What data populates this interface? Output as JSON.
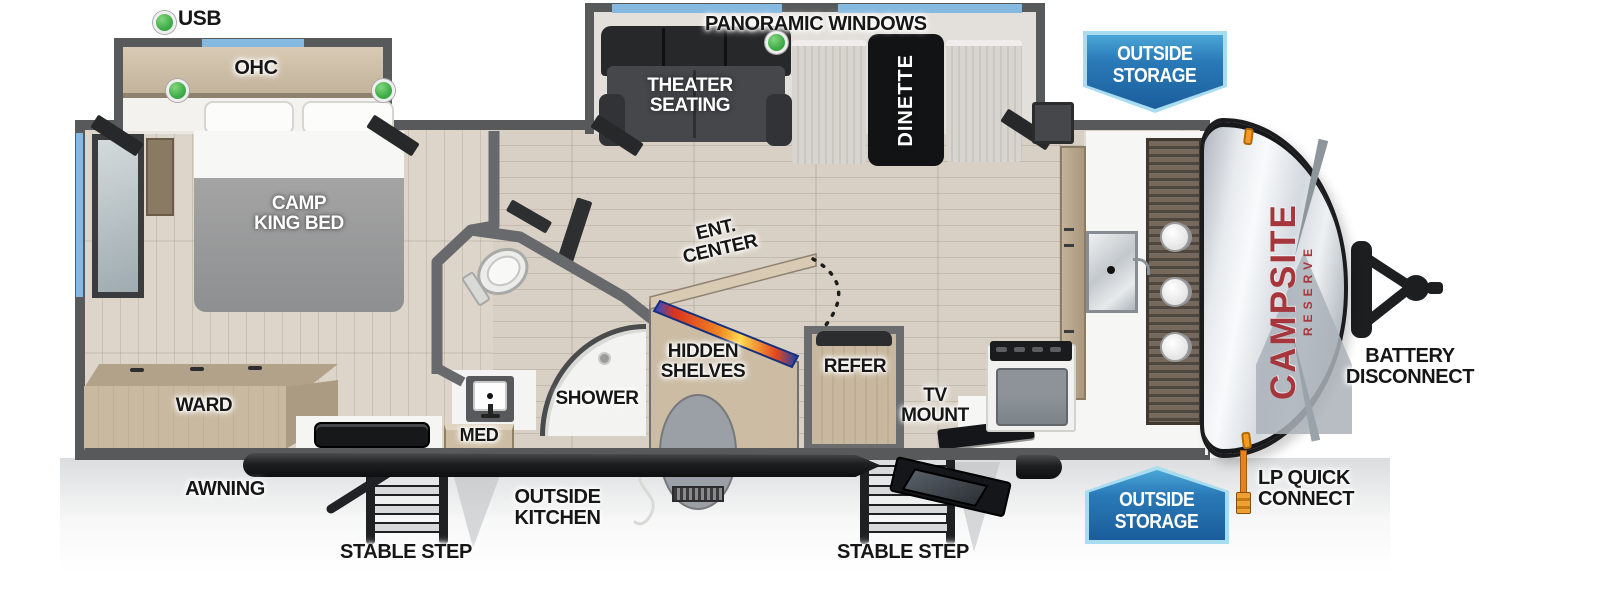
{
  "palette": {
    "wall": "#58595b",
    "window_blue": "#85b9e0",
    "badge_blue": "#1b5d9b",
    "usb_green": "#3fae49",
    "brand_red": "#a6353c",
    "wood": "#c9b9a1",
    "floor": "#d8d0c4"
  },
  "legend": {
    "usb": "USB",
    "panoramic_windows": "PANORAMIC WINDOWS"
  },
  "badges": {
    "outside_storage_top": {
      "line1": "OUTSIDE",
      "line2": "STORAGE"
    },
    "outside_storage_bottom": {
      "line1": "OUTSIDE",
      "line2": "STORAGE"
    }
  },
  "exterior": {
    "awning": "AWNING",
    "stable_step_left": "STABLE STEP",
    "stable_step_right": "STABLE STEP",
    "outside_kitchen": {
      "line1": "OUTSIDE",
      "line2": "KITCHEN"
    },
    "lp_quick_connect": {
      "line1": "LP QUICK",
      "line2": "CONNECT"
    },
    "battery_disconnect": {
      "line1": "BATTERY",
      "line2": "DISCONNECT"
    }
  },
  "brand": {
    "name": "CAMPSITE",
    "series": "RESERVE"
  },
  "rooms": {
    "ohc": "OHC",
    "camp_king_bed": {
      "line1": "CAMP",
      "line2": "KING BED"
    },
    "ward": "WARD",
    "med": "MED",
    "shower": "SHOWER",
    "theater_seating": {
      "line1": "THEATER",
      "line2": "SEATING"
    },
    "dinette": "DINETTE",
    "ent_center": {
      "line1": "ENT.",
      "line2": "CENTER"
    },
    "hidden_shelves": {
      "line1": "HIDDEN",
      "line2": "SHELVES"
    },
    "refer": "REFER",
    "tv_mount": {
      "line1": "TV",
      "line2": "MOUNT"
    }
  }
}
